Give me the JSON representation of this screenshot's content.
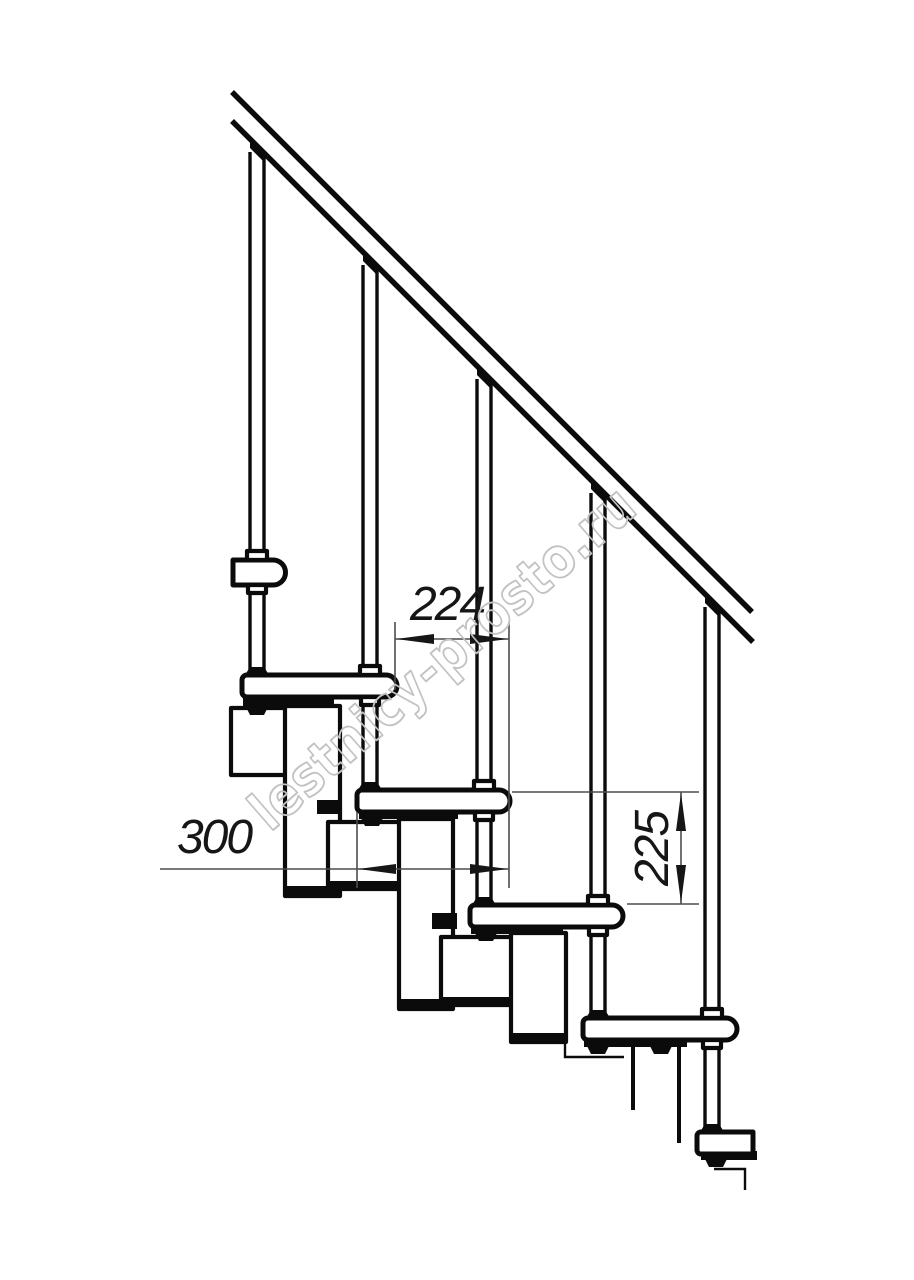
{
  "document": {
    "kind": "modular-staircase side-view technical drawing",
    "background": "#ffffff"
  },
  "dimensions": {
    "step_run": {
      "label": "224"
    },
    "tread_depth": {
      "label": "300"
    },
    "step_rise": {
      "label": "225"
    }
  },
  "watermark": {
    "text": "lestnicy-prosto.ru",
    "color": "#c2c2c2"
  },
  "colors": {
    "outline": "#0b0b0b",
    "dimension_lines": "#4d4d4d",
    "dimension_text": "#161616"
  }
}
